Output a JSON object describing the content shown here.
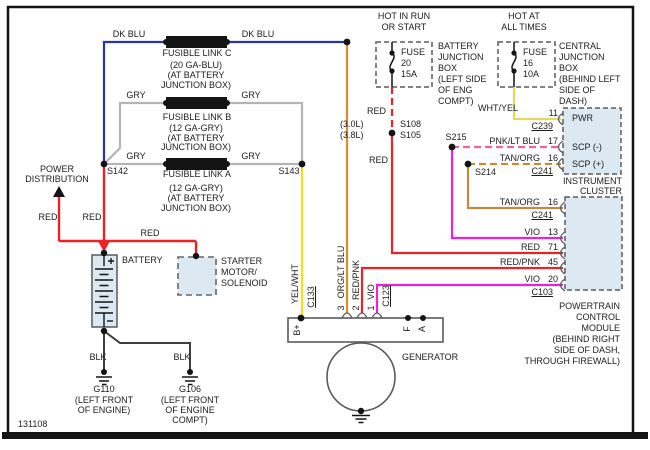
{
  "diagram": {
    "number": "131108",
    "colors": {
      "dk_blu": "#2a35a0",
      "gry": "#b4b4b4",
      "yel": "#f2df1f",
      "wht_yel": "#e4d95e",
      "org": "#e08c28",
      "red": "#ec2227",
      "vio": "#e822dd",
      "pnk": "#f4628e",
      "tan": "#c08b3e",
      "blk": "#3d3d3d",
      "box_fill": "#dce9f3",
      "outline": "#5a5a5a",
      "ink": "#1c1c1c"
    },
    "labels": [
      {
        "n": "dk-blu-left",
        "t": "DK BLU",
        "x": 129,
        "y": 34,
        "a": "c"
      },
      {
        "n": "dk-blu-right",
        "t": "DK BLU",
        "x": 258,
        "y": 34,
        "a": "c"
      },
      {
        "n": "fusible-link-c",
        "t": "FUSIBLE LINK C",
        "x": 197,
        "y": 53,
        "a": "c"
      },
      {
        "n": "link-c-gauge",
        "t": "(20 GA-BLU)",
        "x": 196,
        "y": 65,
        "a": "c"
      },
      {
        "n": "link-c-loc1",
        "t": "(AT BATTERY",
        "x": 196,
        "y": 75,
        "a": "c"
      },
      {
        "n": "link-c-loc2",
        "t": "JUNCTION BOX)",
        "x": 196,
        "y": 85,
        "a": "c"
      },
      {
        "n": "gry-b-left",
        "t": "GRY",
        "x": 136,
        "y": 95,
        "a": "c"
      },
      {
        "n": "gry-b-right",
        "t": "GRY",
        "x": 251,
        "y": 95,
        "a": "c"
      },
      {
        "n": "fusible-link-b",
        "t": "FUSIBLE LINK B",
        "x": 197,
        "y": 117,
        "a": "c"
      },
      {
        "n": "link-b-gauge",
        "t": "(12 GA-GRY)",
        "x": 196,
        "y": 128,
        "a": "c"
      },
      {
        "n": "link-b-loc1",
        "t": "(AT BATTERY",
        "x": 196,
        "y": 138,
        "a": "c"
      },
      {
        "n": "link-b-loc2",
        "t": "JUNCTION BOX)",
        "x": 196,
        "y": 147,
        "a": "c"
      },
      {
        "n": "gry-a-left",
        "t": "GRY",
        "x": 136,
        "y": 156,
        "a": "c"
      },
      {
        "n": "gry-a-right",
        "t": "GRY",
        "x": 251,
        "y": 156,
        "a": "c"
      },
      {
        "n": "fusible-link-a",
        "t": "FUSIBLE LINK A",
        "x": 197,
        "y": 174,
        "a": "c"
      },
      {
        "n": "link-a-gauge",
        "t": "(12 GA-GRY)",
        "x": 196,
        "y": 188,
        "a": "c"
      },
      {
        "n": "link-a-loc1",
        "t": "(AT BATTERY",
        "x": 196,
        "y": 198,
        "a": "c"
      },
      {
        "n": "link-a-loc2",
        "t": "JUNCTION BOX)",
        "x": 196,
        "y": 208,
        "a": "c"
      },
      {
        "n": "splice-s142",
        "t": "S142",
        "x": 107,
        "y": 171,
        "a": "l"
      },
      {
        "n": "splice-s143",
        "t": "S143",
        "x": 289,
        "y": 171,
        "a": "c"
      },
      {
        "n": "power-dist-1",
        "t": "POWER",
        "x": 57,
        "y": 169,
        "a": "c"
      },
      {
        "n": "power-dist-2",
        "t": "DISTRIBUTION",
        "x": 57,
        "y": 179,
        "a": "c"
      },
      {
        "n": "red-power-dist",
        "t": "RED",
        "x": 48,
        "y": 217,
        "a": "c"
      },
      {
        "n": "red-battery",
        "t": "RED",
        "x": 92,
        "y": 217,
        "a": "c"
      },
      {
        "n": "red-starter",
        "t": "RED",
        "x": 150,
        "y": 233,
        "a": "c"
      },
      {
        "n": "battery-label",
        "t": "BATTERY",
        "x": 122,
        "y": 260,
        "a": "l"
      },
      {
        "n": "starter-1",
        "t": "STARTER",
        "x": 221,
        "y": 261,
        "a": "l"
      },
      {
        "n": "starter-2",
        "t": "MOTOR/",
        "x": 221,
        "y": 272,
        "a": "l"
      },
      {
        "n": "starter-3",
        "t": "SOLENOID",
        "x": 221,
        "y": 283,
        "a": "l"
      },
      {
        "n": "blk-left",
        "t": "BLK",
        "x": 98,
        "y": 357,
        "a": "c"
      },
      {
        "n": "blk-right",
        "t": "BLK",
        "x": 182,
        "y": 357,
        "a": "c"
      },
      {
        "n": "g110",
        "t": "G110",
        "x": 104,
        "y": 389,
        "a": "c"
      },
      {
        "n": "g110-loc1",
        "t": "(LEFT FRONT",
        "x": 104,
        "y": 400,
        "a": "c"
      },
      {
        "n": "g110-loc2",
        "t": "OF ENGINE)",
        "x": 104,
        "y": 410,
        "a": "c"
      },
      {
        "n": "g106",
        "t": "G106",
        "x": 190,
        "y": 389,
        "a": "c"
      },
      {
        "n": "g106-loc1",
        "t": "(LEFT FRONT",
        "x": 190,
        "y": 400,
        "a": "c"
      },
      {
        "n": "g106-loc2",
        "t": "OF ENGINE",
        "x": 190,
        "y": 410,
        "a": "c"
      },
      {
        "n": "g106-loc3",
        "t": "COMPT)",
        "x": 190,
        "y": 420,
        "a": "c"
      },
      {
        "n": "hot-in-run-1",
        "t": "HOT IN RUN",
        "x": 404,
        "y": 16,
        "a": "c"
      },
      {
        "n": "hot-in-run-2",
        "t": "OR START",
        "x": 404,
        "y": 27,
        "a": "c"
      },
      {
        "n": "fuse20-1",
        "t": "FUSE",
        "x": 401,
        "y": 52,
        "a": "l"
      },
      {
        "n": "fuse20-2",
        "t": "20",
        "x": 401,
        "y": 63,
        "a": "l"
      },
      {
        "n": "fuse20-3",
        "t": "15A",
        "x": 401,
        "y": 74,
        "a": "l"
      },
      {
        "n": "bjb-1",
        "t": "BATTERY",
        "x": 438,
        "y": 46,
        "a": "l"
      },
      {
        "n": "bjb-2",
        "t": "JUNCTION",
        "x": 438,
        "y": 57,
        "a": "l"
      },
      {
        "n": "bjb-3",
        "t": "BOX",
        "x": 438,
        "y": 68,
        "a": "l"
      },
      {
        "n": "bjb-4",
        "t": "(LEFT SIDE",
        "x": 438,
        "y": 79,
        "a": "l"
      },
      {
        "n": "bjb-5",
        "t": "OF ENG",
        "x": 438,
        "y": 90,
        "a": "l"
      },
      {
        "n": "bjb-6",
        "t": "COMPT)",
        "x": 438,
        "y": 101,
        "a": "l"
      },
      {
        "n": "hot-at-1",
        "t": "HOT AT",
        "x": 524,
        "y": 16,
        "a": "c"
      },
      {
        "n": "hot-at-2",
        "t": "ALL TIMES",
        "x": 524,
        "y": 27,
        "a": "c"
      },
      {
        "n": "fuse16-1",
        "t": "FUSE",
        "x": 523,
        "y": 52,
        "a": "l"
      },
      {
        "n": "fuse16-2",
        "t": "16",
        "x": 523,
        "y": 63,
        "a": "l"
      },
      {
        "n": "fuse16-3",
        "t": "10A",
        "x": 523,
        "y": 74,
        "a": "l"
      },
      {
        "n": "cjb-1",
        "t": "CENTRAL",
        "x": 559,
        "y": 46,
        "a": "l"
      },
      {
        "n": "cjb-2",
        "t": "JUNCTION",
        "x": 559,
        "y": 57,
        "a": "l"
      },
      {
        "n": "cjb-3",
        "t": "BOX",
        "x": 559,
        "y": 68,
        "a": "l"
      },
      {
        "n": "cjb-4",
        "t": "(BEHIND LEFT",
        "x": 559,
        "y": 79,
        "a": "l"
      },
      {
        "n": "cjb-5",
        "t": "SIDE OF",
        "x": 559,
        "y": 90,
        "a": "l"
      },
      {
        "n": "cjb-6",
        "t": "DASH)",
        "x": 559,
        "y": 101,
        "a": "l"
      },
      {
        "n": "red-fuse",
        "t": "RED",
        "x": 386,
        "y": 111,
        "a": "r"
      },
      {
        "n": "engine-30",
        "t": "(3.0L)",
        "x": 340,
        "y": 124,
        "a": "l"
      },
      {
        "n": "engine-38",
        "t": "(3.8L)",
        "x": 340,
        "y": 135,
        "a": "l"
      },
      {
        "n": "splice-s108",
        "t": "S108",
        "x": 400,
        "y": 124,
        "a": "l"
      },
      {
        "n": "splice-s105",
        "t": "S105",
        "x": 400,
        "y": 135,
        "a": "l"
      },
      {
        "n": "red-mid",
        "t": "RED",
        "x": 388,
        "y": 160,
        "a": "r"
      },
      {
        "n": "splice-s215",
        "t": "S215",
        "x": 456,
        "y": 137,
        "a": "c"
      },
      {
        "n": "splice-s214",
        "t": "S214",
        "x": 475,
        "y": 172,
        "a": "l"
      },
      {
        "n": "wht-yel",
        "t": "WHT/YEL",
        "x": 518,
        "y": 108,
        "a": "r"
      },
      {
        "n": "pin-11",
        "t": "11",
        "x": 558,
        "y": 113,
        "a": "r"
      },
      {
        "n": "conn-c239",
        "t": "C239",
        "x": 553,
        "y": 126,
        "a": "r",
        "u": true
      },
      {
        "n": "pnk-lt-blu",
        "t": "PNK/LT BLU",
        "x": 540,
        "y": 141,
        "a": "r"
      },
      {
        "n": "pin-17",
        "t": "17",
        "x": 558,
        "y": 141,
        "a": "r"
      },
      {
        "n": "tan-org-scp",
        "t": "TAN/ORG",
        "x": 540,
        "y": 158,
        "a": "r"
      },
      {
        "n": "pin-16-cluster",
        "t": "16",
        "x": 558,
        "y": 158,
        "a": "r"
      },
      {
        "n": "conn-c241-cluster",
        "t": "C241",
        "x": 553,
        "y": 171,
        "a": "r",
        "u": true
      },
      {
        "n": "cluster-name-1",
        "t": "INSTRUMENT",
        "x": 622,
        "y": 181,
        "a": "r"
      },
      {
        "n": "cluster-name-2",
        "t": "CLUSTER",
        "x": 622,
        "y": 191,
        "a": "r"
      },
      {
        "n": "tan-org-pcm",
        "t": "TAN/ORG",
        "x": 540,
        "y": 202,
        "a": "r"
      },
      {
        "n": "pin-16-pcm",
        "t": "16",
        "x": 558,
        "y": 202,
        "a": "r"
      },
      {
        "n": "conn-c241-pcm",
        "t": "C241",
        "x": 553,
        "y": 215,
        "a": "r",
        "u": true
      },
      {
        "n": "vio-13",
        "t": "VIO",
        "x": 540,
        "y": 232,
        "a": "r"
      },
      {
        "n": "pin-13",
        "t": "13",
        "x": 558,
        "y": 232,
        "a": "r"
      },
      {
        "n": "red-71",
        "t": "RED",
        "x": 540,
        "y": 247,
        "a": "r"
      },
      {
        "n": "pin-71",
        "t": "71",
        "x": 558,
        "y": 247,
        "a": "r"
      },
      {
        "n": "red-pnk-45",
        "t": "RED/PNK",
        "x": 540,
        "y": 262,
        "a": "r"
      },
      {
        "n": "pin-45",
        "t": "45",
        "x": 558,
        "y": 262,
        "a": "r"
      },
      {
        "n": "vio-20",
        "t": "VIO",
        "x": 540,
        "y": 279,
        "a": "r"
      },
      {
        "n": "pin-20",
        "t": "20",
        "x": 558,
        "y": 279,
        "a": "r"
      },
      {
        "n": "conn-c103",
        "t": "C103",
        "x": 553,
        "y": 292,
        "a": "r",
        "u": true
      },
      {
        "n": "cluster-pin-pwr",
        "t": "PWR",
        "x": 572,
        "y": 118,
        "a": "l"
      },
      {
        "n": "cluster-pin-scp-minus",
        "t": "SCP (-)",
        "x": 572,
        "y": 147,
        "a": "l"
      },
      {
        "n": "cluster-pin-scp-plus",
        "t": "SCP (+)",
        "x": 572,
        "y": 164,
        "a": "l"
      },
      {
        "n": "pcm-name-1",
        "t": "POWERTRAIN",
        "x": 620,
        "y": 306,
        "a": "r"
      },
      {
        "n": "pcm-name-2",
        "t": "CONTROL",
        "x": 620,
        "y": 317,
        "a": "r"
      },
      {
        "n": "pcm-name-3",
        "t": "MODULE",
        "x": 620,
        "y": 328,
        "a": "r"
      },
      {
        "n": "pcm-name-4",
        "t": "(BEHIND RIGHT",
        "x": 620,
        "y": 339,
        "a": "r"
      },
      {
        "n": "pcm-name-5",
        "t": "SIDE OF DASH,",
        "x": 620,
        "y": 350,
        "a": "r"
      },
      {
        "n": "pcm-name-6",
        "t": "THROUGH FIREWALL)",
        "x": 620,
        "y": 361,
        "a": "r"
      },
      {
        "n": "yel-wht-vert",
        "t": "YEL/WHT",
        "x": 295,
        "y": 284,
        "a": "v"
      },
      {
        "n": "conn-c133",
        "t": "C133",
        "x": 311,
        "y": 297,
        "a": "v",
        "u": true
      },
      {
        "n": "org-lt-blu-vert",
        "t": "ORG/LT BLU",
        "x": 341,
        "y": 272,
        "a": "v"
      },
      {
        "n": "gen-pin-3",
        "t": "3",
        "x": 341,
        "y": 308,
        "a": "v"
      },
      {
        "n": "red-pnk-vert",
        "t": "RED/PNK",
        "x": 356,
        "y": 280,
        "a": "v"
      },
      {
        "n": "gen-pin-2",
        "t": "2",
        "x": 356,
        "y": 308,
        "a": "v"
      },
      {
        "n": "vio-vert",
        "t": "VIO",
        "x": 371,
        "y": 292,
        "a": "v"
      },
      {
        "n": "gen-pin-1",
        "t": "1",
        "x": 371,
        "y": 308,
        "a": "v"
      },
      {
        "n": "conn-c123",
        "t": "C123",
        "x": 386,
        "y": 296,
        "a": "v",
        "u": true
      },
      {
        "n": "gen-term-bplus",
        "t": "B+",
        "x": 297,
        "y": 330,
        "a": "v"
      },
      {
        "n": "gen-term-f",
        "t": "F",
        "x": 407,
        "y": 329,
        "a": "v"
      },
      {
        "n": "gen-term-a",
        "t": "A",
        "x": 422,
        "y": 329,
        "a": "v"
      },
      {
        "n": "generator-label",
        "t": "GENERATOR",
        "x": 402,
        "y": 357,
        "a": "l"
      }
    ]
  }
}
